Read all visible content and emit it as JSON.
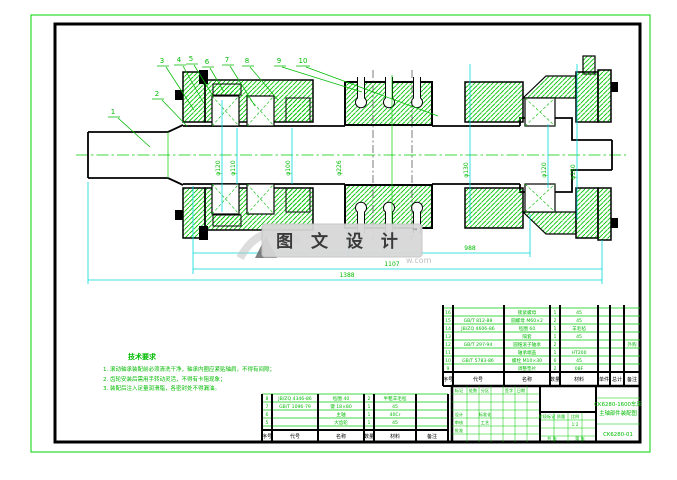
{
  "colors": {
    "line_green": "#00cc00",
    "text_green": "#00bb00",
    "dim_cyan": "#00d9d9",
    "frame_black": "#000000",
    "watermark_box": "#d7d7d7",
    "watermark_text": "#3a3a3a"
  },
  "watermark": {
    "label": "图 文 设 计",
    "corner_mark": "™",
    "url_fragment": "w.com"
  },
  "balloons": [
    "1",
    "2",
    "3",
    "4",
    "5",
    "6",
    "7",
    "8",
    "9",
    "10"
  ],
  "dimensions": {
    "bottom_dim_1": "988",
    "bottom_dim_2": "1107",
    "bottom_dim_3": "1388",
    "phi_left_outer": "φ120",
    "phi_left_mid": "φ110",
    "phi_left_inner": "φ100",
    "phi_gear": "φ226",
    "phi_right_outer": "φ130",
    "phi_right_mid": "φ120",
    "phi_right_end": "φ150"
  },
  "notes": {
    "heading": "技术要求",
    "items": [
      "1. 滚动轴承装配前必须清洗干净，轴承内圈应紧贴轴肩，不得有间隙；",
      "2. 齿轮安装后需用手转动灵活，不得有卡阻现象；",
      "3. 装配后注入足量润滑脂，各密封处不得漏油。"
    ]
  },
  "bom_right": {
    "headers": [
      "序号",
      "代号",
      "名称",
      "数量",
      "材料",
      "单件",
      "总计",
      "备注"
    ],
    "rows": [
      {
        "seq": "16",
        "code": "",
        "name": "锁紧螺母",
        "qty": "1",
        "mat": "45",
        "rem": ""
      },
      {
        "seq": "15",
        "code": "GB/T 812-88",
        "name": "圆螺母 M60×2",
        "qty": "2",
        "mat": "45",
        "rem": ""
      },
      {
        "seq": "14",
        "code": "JB/ZQ 4606-86",
        "name": "毡圈 60",
        "qty": "1",
        "mat": "羊毛毡",
        "rem": ""
      },
      {
        "seq": "13",
        "code": "",
        "name": "隔套",
        "qty": "1",
        "mat": "45",
        "rem": ""
      },
      {
        "seq": "12",
        "code": "GB/T 297-94",
        "name": "圆锥滚子轴承",
        "qty": "2",
        "mat": "",
        "rem": "外购"
      },
      {
        "seq": "11",
        "code": "",
        "name": "轴承端盖",
        "qty": "1",
        "mat": "HT200",
        "rem": ""
      },
      {
        "seq": "10",
        "code": "GB/T 5783-86",
        "name": "螺栓 M10×30",
        "qty": "6",
        "mat": "45",
        "rem": ""
      },
      {
        "seq": "9",
        "code": "",
        "name": "调整垫片",
        "qty": "2",
        "mat": "08F",
        "rem": ""
      }
    ]
  },
  "bom_bottom": {
    "headers": [
      "序号",
      "代号",
      "名称",
      "数量",
      "材料",
      "备注"
    ],
    "rows": [
      {
        "seq": "8",
        "code": "JB/ZQ 4346-86",
        "name": "毡圈 40",
        "qty": "2",
        "mat": "半粗羊毛毡"
      },
      {
        "seq": "7",
        "code": "GB/T 1096-79",
        "name": "键 18×80",
        "qty": "1",
        "mat": "45"
      },
      {
        "seq": "6",
        "code": "",
        "name": "主轴",
        "qty": "1",
        "mat": "40Cr"
      },
      {
        "seq": "5",
        "code": "",
        "name": "大齿轮",
        "qty": "1",
        "mat": "45"
      }
    ]
  },
  "title_block": {
    "title_line1": "CK6280-1600车床",
    "title_line2": "主轴部件装配图",
    "drawing_no": "CK6280-01",
    "fields": {
      "mark": "标记",
      "count": "处数",
      "zone": "分区",
      "sign": "签字",
      "date": "日期",
      "design": "设计",
      "check": "审核",
      "std": "标准化",
      "craft": "工艺",
      "approve": "批准",
      "stage": "阶段标记",
      "weight": "质量",
      "scale_label": "比例",
      "scale": "1:2",
      "sheets": "共 张",
      "sheet": "第 张"
    }
  }
}
